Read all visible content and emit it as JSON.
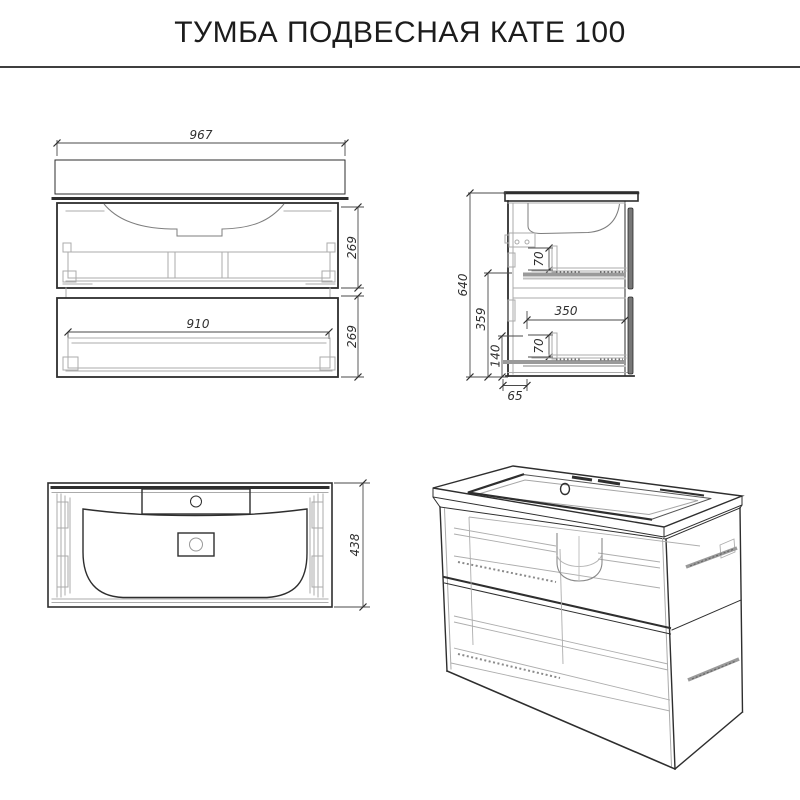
{
  "title": "ТУМБА ПОДВЕСНАЯ КАТЕ 100",
  "dimensions": {
    "front": {
      "overall_width": "967",
      "drawer_inner_width": "910",
      "upper_drawer_height": "269",
      "lower_drawer_height": "269"
    },
    "side": {
      "overall_height": "640",
      "upper_section": "359",
      "lower_section": "140",
      "upper_drawer_front": "70",
      "lower_drawer_front": "70",
      "drawer_depth": "350",
      "wall_offset": "65"
    },
    "top": {
      "overall_depth": "438"
    }
  }
}
